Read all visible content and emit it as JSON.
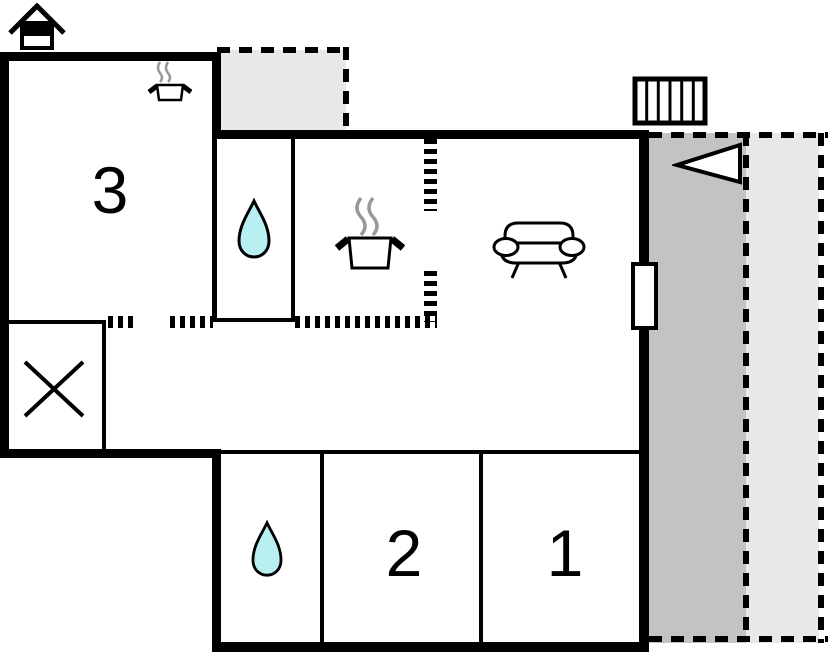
{
  "floor_plan": {
    "rooms": [
      {
        "id": "room-3",
        "label": "3"
      },
      {
        "id": "room-2",
        "label": "2"
      },
      {
        "id": "room-1",
        "label": "1"
      }
    ],
    "icons": {
      "house": "house-icon",
      "kitchenette": "kitchenette-stove-icon",
      "stove": "stove-icon",
      "water_drop_upper": "water-drop-icon",
      "water_drop_lower": "water-drop-icon",
      "sofa": "sofa-icon",
      "stairs": "stairs-icon",
      "direction_arrow": "direction-arrow-icon",
      "crossed_square": "crossed-square-icon"
    },
    "colors": {
      "wall": "#000000",
      "background": "#ffffff",
      "terrace_dark": "#c3c3c3",
      "terrace_light": "#e8e8e8",
      "water": "#b8f0f2",
      "steam": "#999999"
    }
  }
}
